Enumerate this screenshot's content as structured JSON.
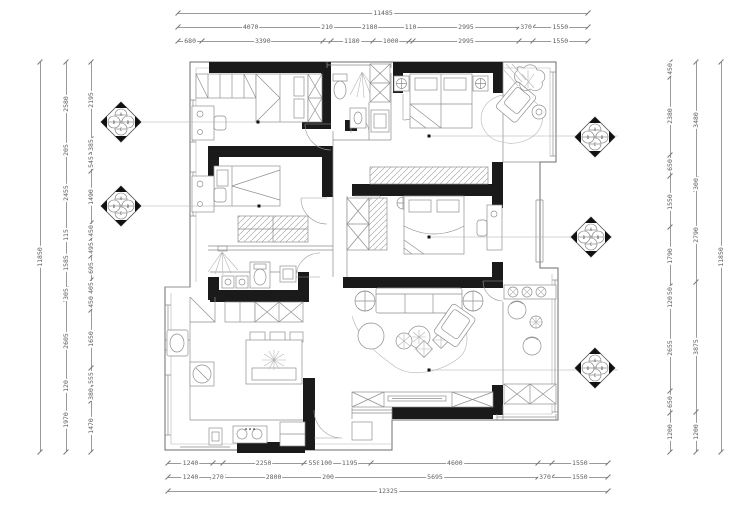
{
  "drawing": {
    "type": "residential-floor-plan",
    "colors": {
      "wall": "#1a1a1a",
      "furniture_line": "#8f8f8f",
      "dim_line": "#9a9a9a",
      "dim_text": "#5f5f5f",
      "background": "#ffffff"
    }
  },
  "markers": {
    "letters": [
      "A",
      "B",
      "C",
      "D"
    ]
  },
  "dims": {
    "top_overall": [
      [
        11485,
        "11485"
      ]
    ],
    "top_row2": [
      [
        4070,
        "4070"
      ],
      [
        210,
        "210"
      ],
      [
        2180,
        "2180"
      ],
      [
        110,
        "110"
      ],
      [
        2995,
        "2995"
      ],
      [
        370,
        "370"
      ],
      [
        1550,
        "1550"
      ]
    ],
    "top_row3": [
      [
        680,
        "680"
      ],
      [
        3390,
        "3390"
      ],
      [
        210,
        ""
      ],
      [
        1180,
        "1180"
      ],
      [
        1000,
        "1000"
      ],
      [
        110,
        ""
      ],
      [
        2995,
        "2995"
      ],
      [
        370,
        ""
      ],
      [
        1550,
        "1550"
      ]
    ],
    "bottom_row1": [
      [
        1240,
        "1240"
      ],
      [
        270,
        ""
      ],
      [
        2250,
        "2250"
      ],
      [
        550,
        "550"
      ],
      [
        100,
        "100"
      ],
      [
        1195,
        "1195"
      ],
      [
        4600,
        "4600"
      ],
      [
        370,
        ""
      ],
      [
        1550,
        "1550"
      ]
    ],
    "bottom_row2": [
      [
        1240,
        "1240"
      ],
      [
        270,
        "270"
      ],
      [
        2800,
        "2800"
      ],
      [
        200,
        "200"
      ],
      [
        5695,
        "5695"
      ],
      [
        370,
        "370"
      ],
      [
        1550,
        "1550"
      ]
    ],
    "bottom_overall": [
      [
        12325,
        "12325"
      ]
    ],
    "left_outer": [
      [
        11850,
        "11850"
      ]
    ],
    "left_mid": [
      [
        2580,
        "2580"
      ],
      [
        205,
        "205"
      ],
      [
        2455,
        "2455"
      ],
      [
        115,
        "115"
      ],
      [
        1585,
        "1585"
      ],
      [
        305,
        "305"
      ],
      [
        2605,
        "2605"
      ],
      [
        120,
        "120"
      ],
      [
        1970,
        "1970"
      ]
    ],
    "left_inner": [
      [
        2195,
        "2195"
      ],
      [
        385,
        "385"
      ],
      [
        545,
        "545"
      ],
      [
        1490,
        "1490"
      ],
      [
        450,
        "450"
      ],
      [
        495,
        "495"
      ],
      [
        695,
        "695"
      ],
      [
        405,
        "405"
      ],
      [
        450,
        "450"
      ],
      [
        1650,
        "1650"
      ],
      [
        555,
        "555"
      ],
      [
        380,
        "380"
      ],
      [
        1470,
        "1470"
      ]
    ],
    "right_inner": [
      [
        450,
        "450"
      ],
      [
        2380,
        "2380"
      ],
      [
        650,
        "650"
      ],
      [
        1550,
        "1550"
      ],
      [
        1790,
        "1790"
      ],
      [
        450,
        "450"
      ],
      [
        120,
        "120"
      ],
      [
        2655,
        "2655"
      ],
      [
        650,
        "650"
      ],
      [
        1200,
        "1200"
      ]
    ],
    "right_mid": [
      [
        3480,
        "3480"
      ],
      [
        300,
        "300"
      ],
      [
        2790,
        "2790"
      ],
      [
        3875,
        "3875"
      ],
      [
        1200,
        "1200"
      ]
    ],
    "right_outer": [
      [
        11850,
        "11850"
      ]
    ]
  }
}
